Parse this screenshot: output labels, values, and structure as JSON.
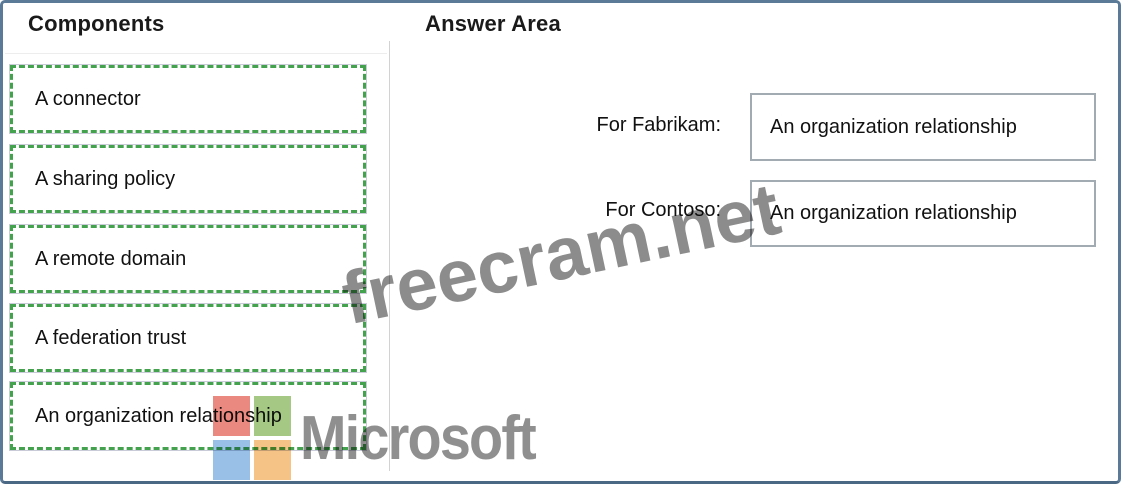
{
  "header": {
    "components_title": "Components",
    "answer_area_title": "Answer Area"
  },
  "components": {
    "items": [
      "A connector",
      "A sharing policy",
      "A remote domain",
      "A federation trust",
      "An organization relationship"
    ]
  },
  "answer_area": {
    "rows": [
      {
        "label": "For Fabrikam:",
        "value": "An organization relationship"
      },
      {
        "label": "For Contoso:",
        "value": "An organization relationship"
      }
    ]
  },
  "watermark": {
    "text": "freecram.net"
  },
  "branding": {
    "wordmark": "Microsoft"
  },
  "colors": {
    "frame_border": "#5a7a97",
    "frame_border_bottom": "#4a6784",
    "dash_green": "#44a24e",
    "answer_border": "#a2aab2",
    "watermark_gray": "#8c8c8c",
    "ms_gray": "#8f8f8f",
    "ms_red": "#e9897f",
    "ms_green": "#a5c884",
    "ms_blue": "#99c1e7",
    "ms_orange": "#f5c386"
  }
}
